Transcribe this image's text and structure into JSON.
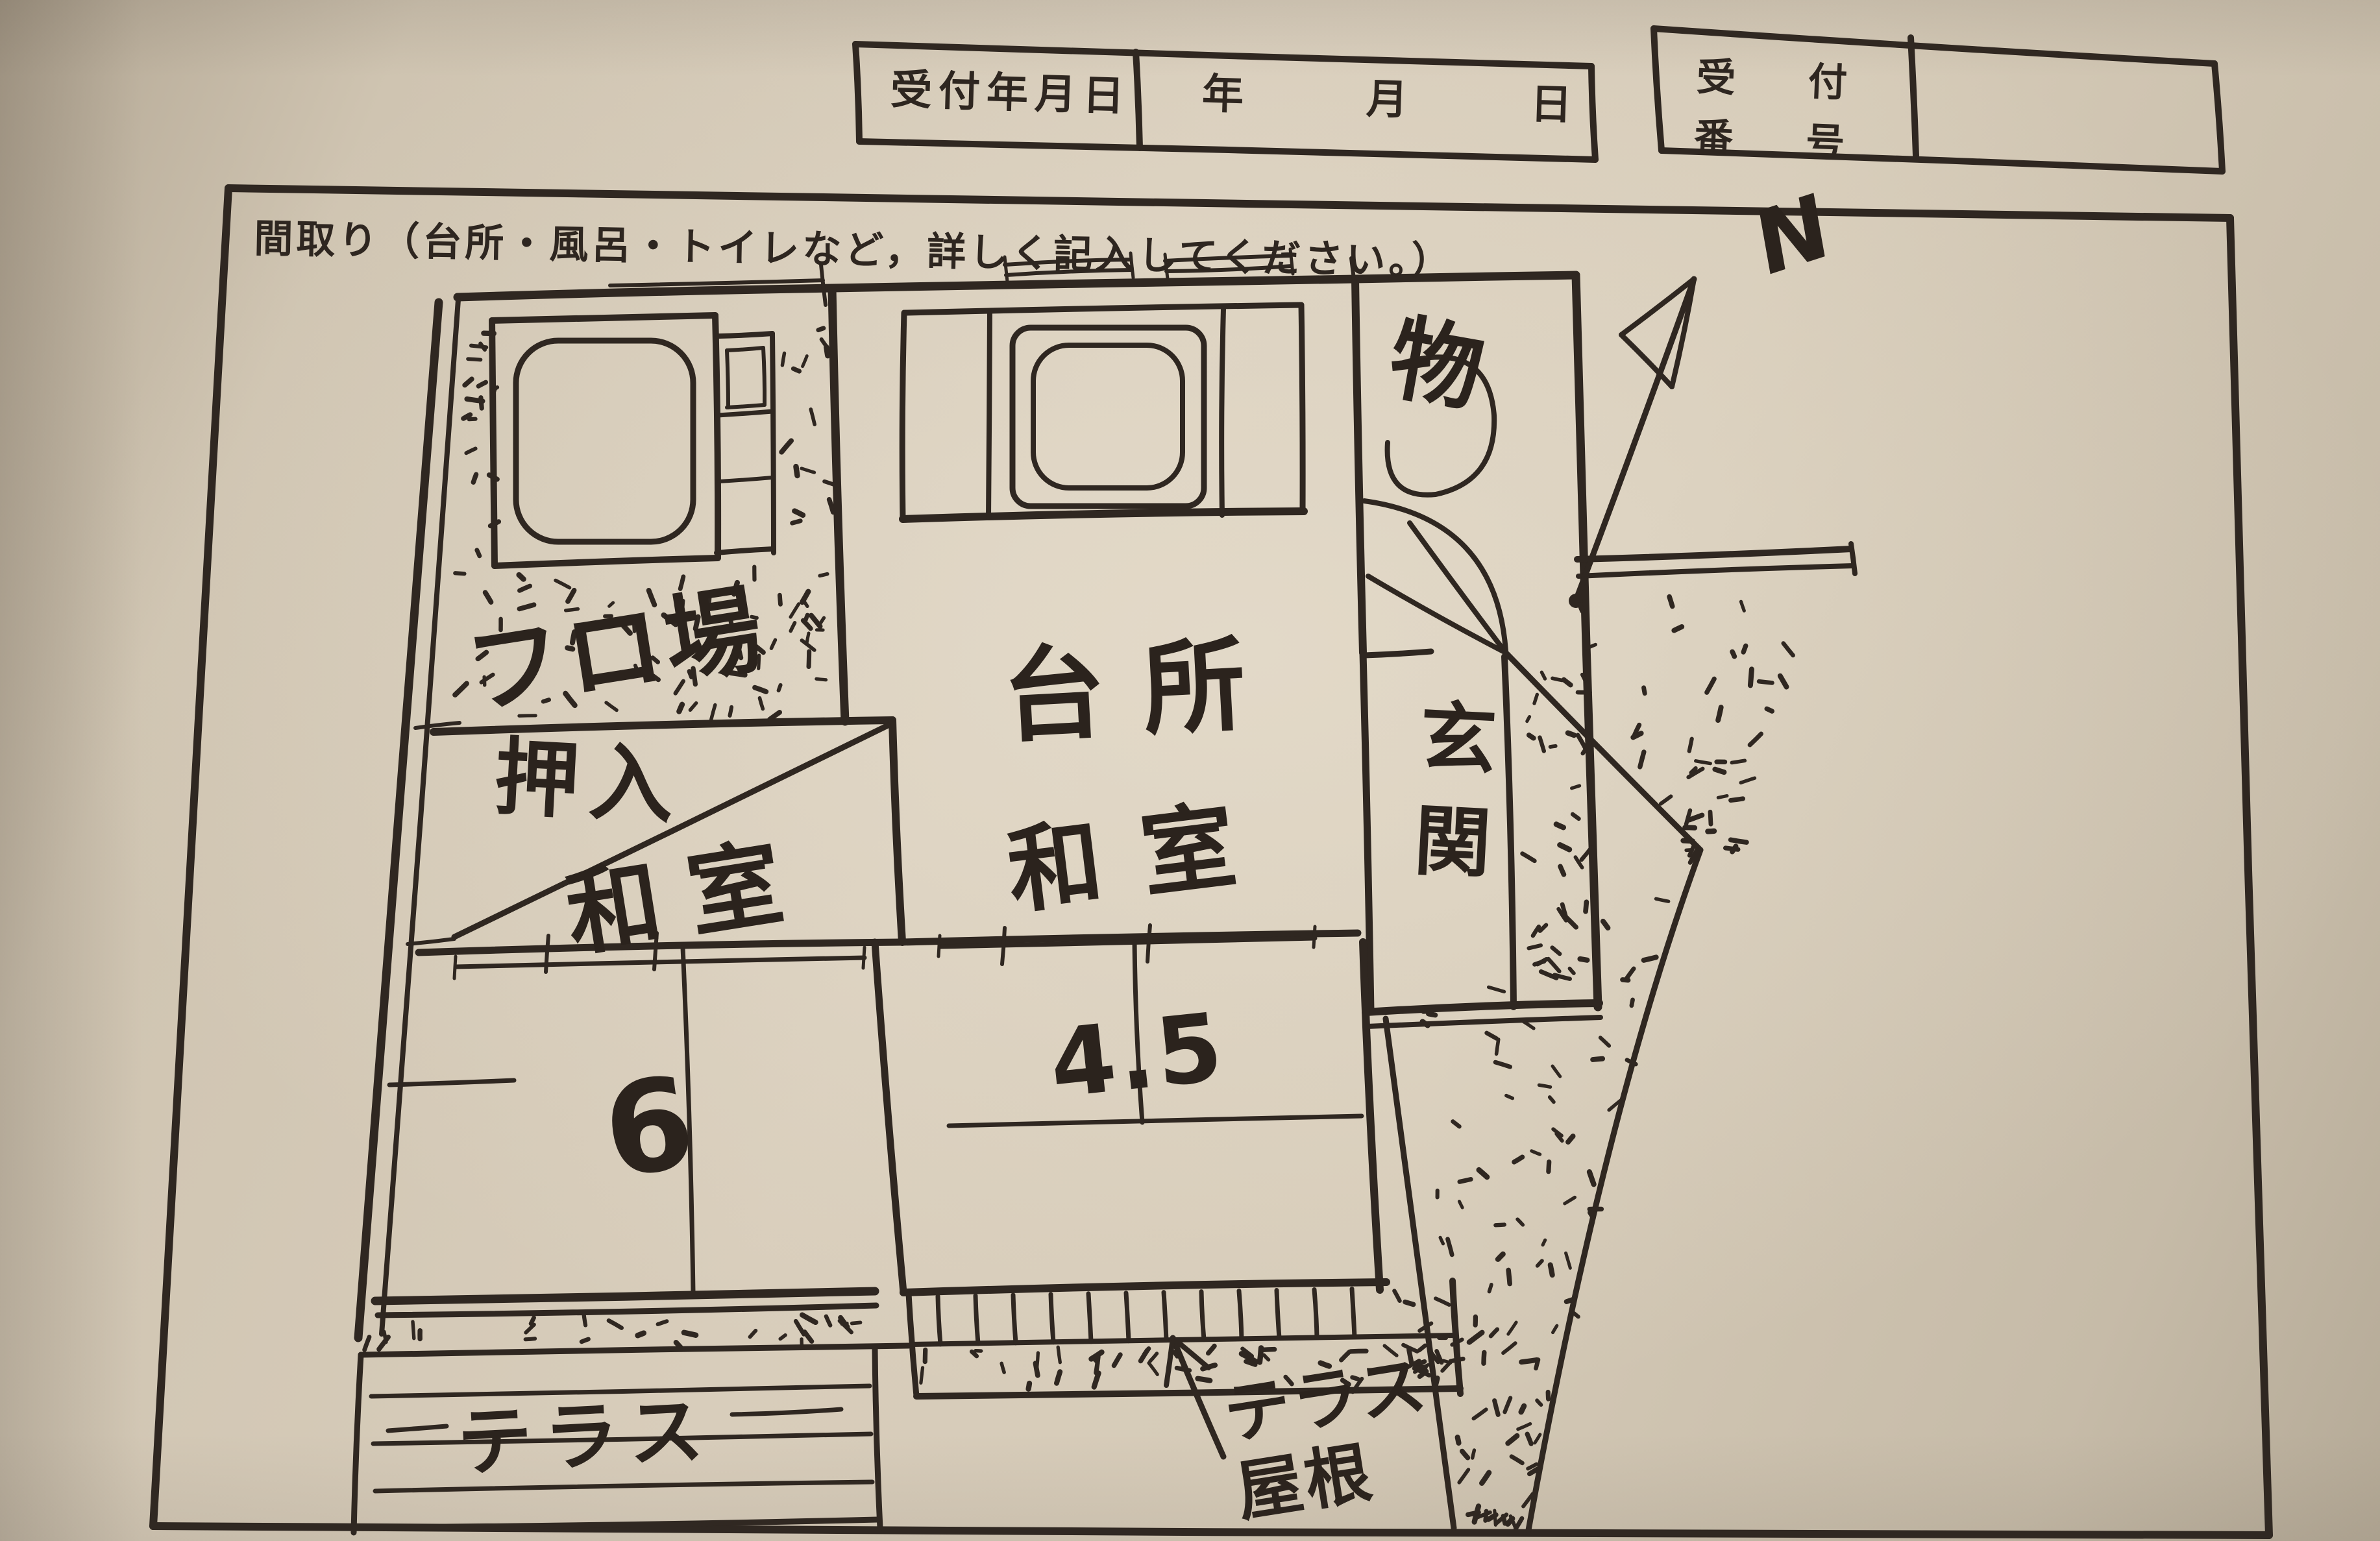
{
  "colors": {
    "ink": "#2f2721",
    "paper": "#d6cbba"
  },
  "header_boxes": {
    "reception_date": {
      "label": "受付年月日",
      "units": [
        "年",
        "月",
        "日"
      ],
      "value": ""
    },
    "reception_number": {
      "label_line1": "受　付",
      "label_line2": "番　号",
      "value": ""
    }
  },
  "floorplan_section": {
    "heading": "間取り（台所・風呂・トイレなど，詳しく記入してください。）",
    "compass_label": "N",
    "rooms": {
      "bath": "フロ場",
      "kitchen": "台所",
      "storage": "物",
      "entrance": "玄関",
      "closet": "押入",
      "japanese_room_left": "和室",
      "japanese_room_left_size": "6",
      "japanese_room_right": "和室",
      "japanese_room_right_size": "4.5",
      "terrace": "テラス",
      "terrace_roof_line1": "テラス",
      "terrace_roof_line2": "屋根"
    }
  }
}
